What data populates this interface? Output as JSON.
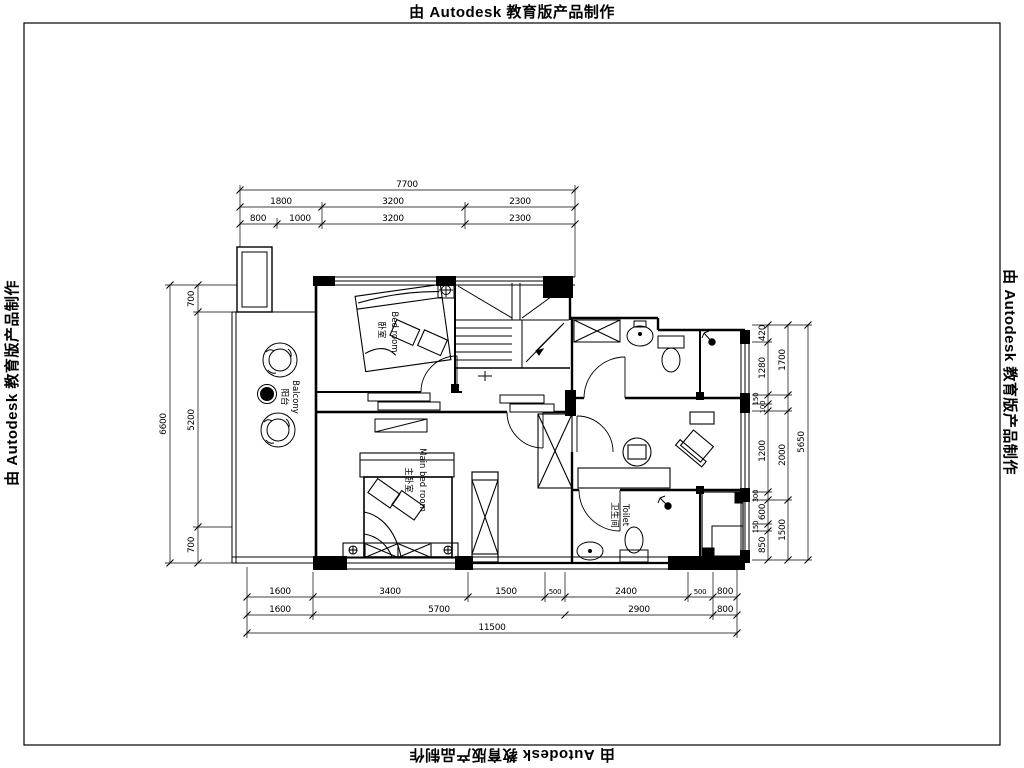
{
  "watermark": {
    "text": "由 Autodesk 教育版产品制作"
  },
  "plan": {
    "rooms": {
      "bedroom": {
        "zh": "卧室",
        "en": "Bed room"
      },
      "master_bedroom": {
        "zh": "主卧室",
        "en": "Main bed room"
      },
      "balcony": {
        "zh": "阳台",
        "en": "Balcony"
      },
      "toilet": {
        "zh": "卫生间",
        "en": "Toilet"
      }
    },
    "dims": {
      "top": {
        "overall": "7700",
        "row2": [
          "1800",
          "3200",
          "2300"
        ],
        "row3": [
          "800",
          "1000",
          "3200",
          "2300"
        ]
      },
      "left": {
        "overall": "6600",
        "inner": [
          "700",
          "5200",
          "700"
        ]
      },
      "bottom": {
        "row1": [
          "1600",
          "3400",
          "1500",
          "500",
          "2400",
          "500",
          "800"
        ],
        "row2": [
          "1600",
          "5700",
          "2900",
          "800"
        ],
        "overall": "11500"
      },
      "right": {
        "inner": [
          "420",
          "1280",
          "150",
          "100",
          "1200",
          "300",
          "600",
          "150",
          "850"
        ],
        "mid": [
          "1700",
          "2000",
          "1500"
        ],
        "overall": "5650"
      }
    }
  }
}
